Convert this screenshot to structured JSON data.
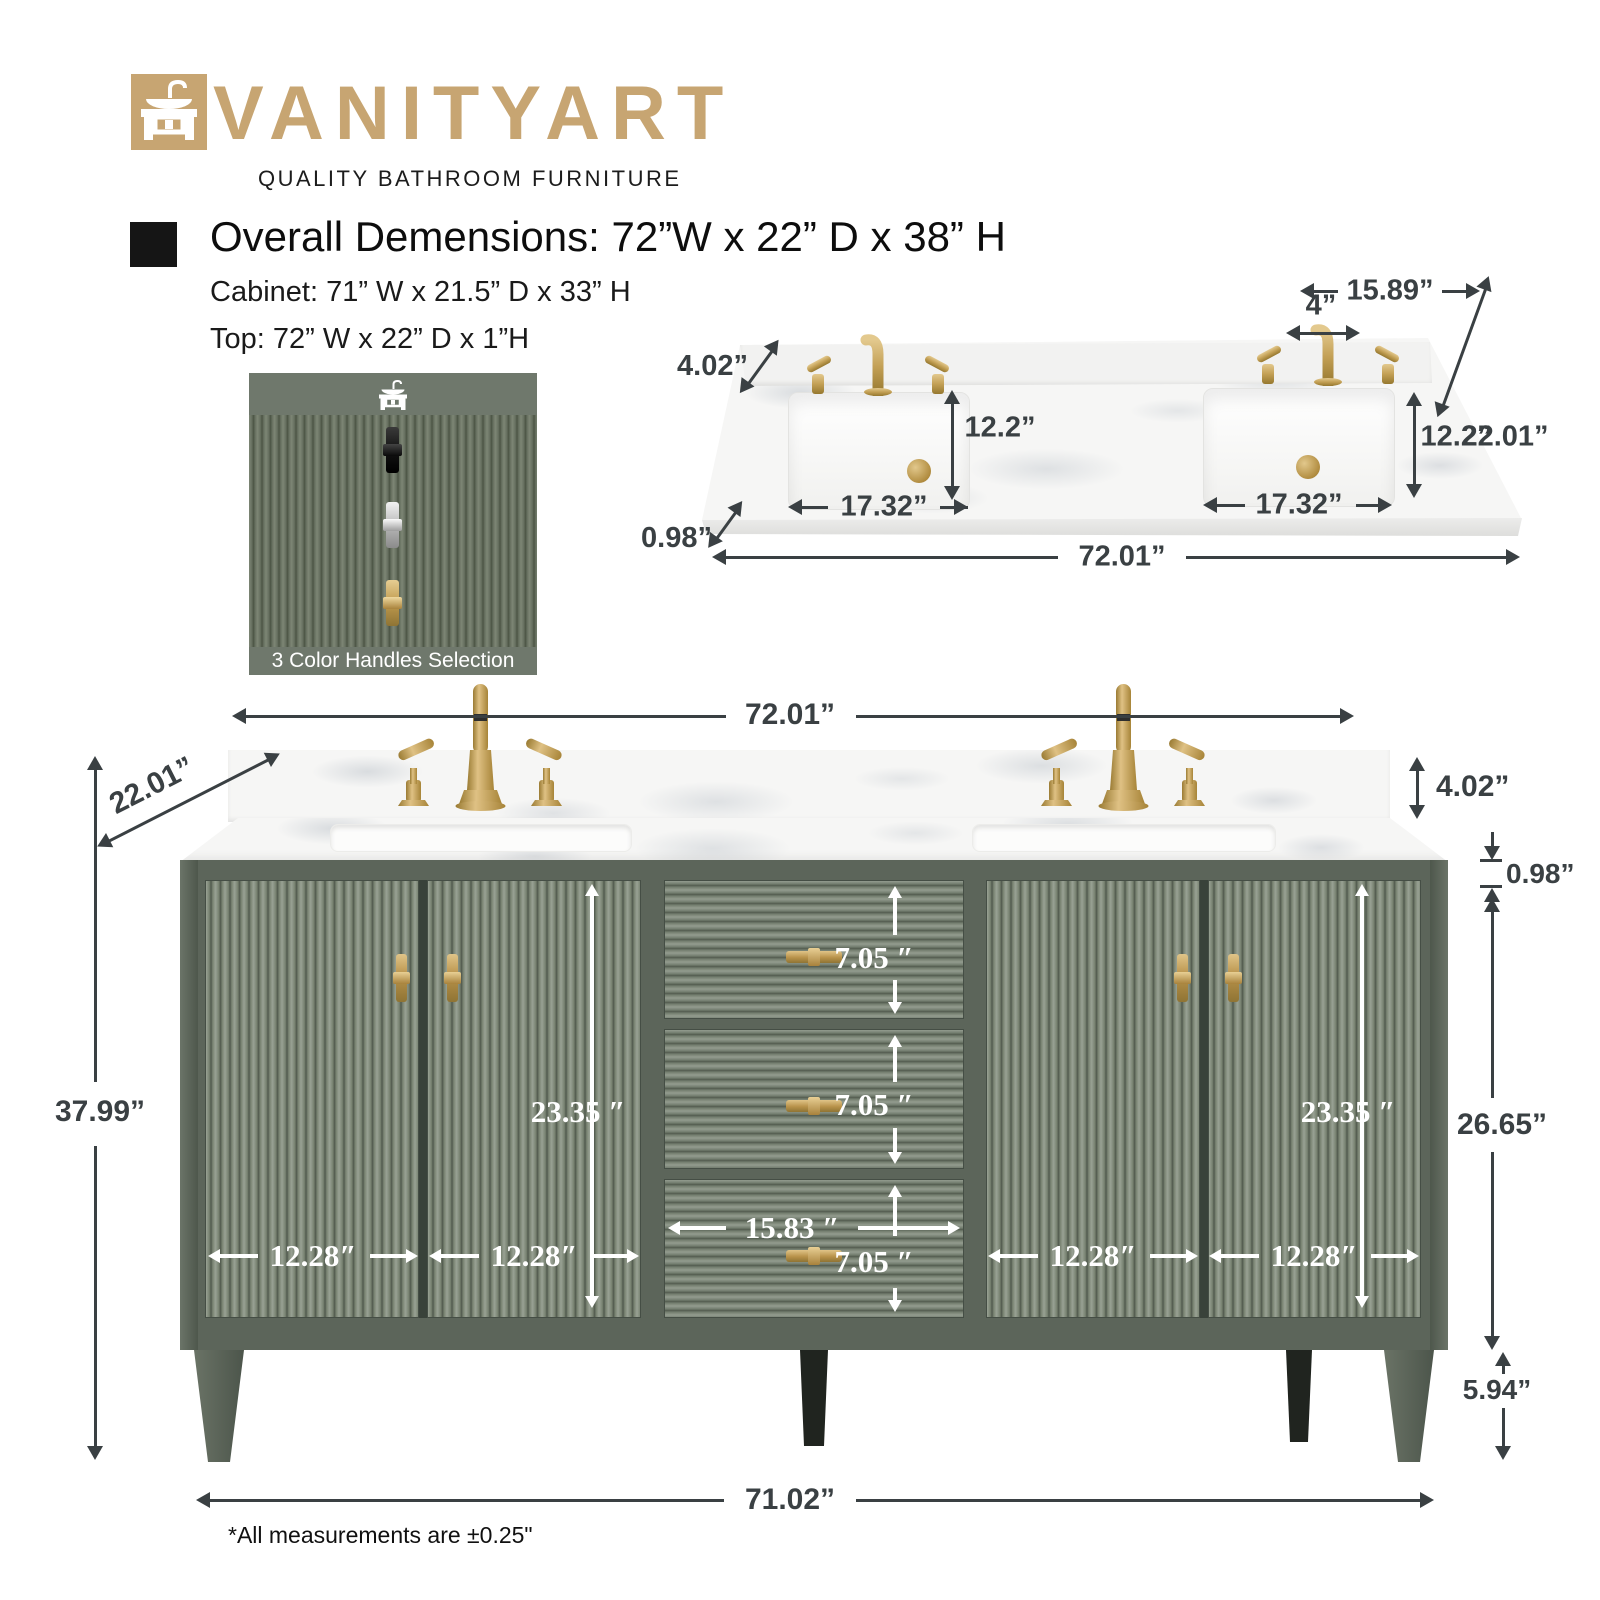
{
  "logo": {
    "brand": "VANITYART",
    "tagline": "QUALITY BATHROOM FURNITURE"
  },
  "header": {
    "title": "Overall Demensions: 72”W x 22” D x 38” H",
    "cabinet_line": "Cabinet: 71” W x 21.5” D x 33” H",
    "top_line": "Top: 72” W x 22” D x 1”H"
  },
  "handles_box": {
    "caption": "3 Color Handles Selection",
    "handle_options": [
      "black",
      "chrome",
      "gold"
    ]
  },
  "countertop": {
    "right_backsplash_width": "15.89”",
    "faucet_spacing": "4”",
    "backsplash_height": "4.02”",
    "sink_depth_left": "12.2”",
    "sink_depth_right": "12.2”",
    "depth": "22.01”",
    "sink_width_left": "17.32”",
    "sink_width_right": "17.32”",
    "thickness": "0.98”",
    "width": "72.01”"
  },
  "vanity": {
    "width": "72.01”",
    "depth": "22.01”",
    "backsplash_height": "4.02”",
    "top_thickness": "0.98”",
    "overall_height": "37.99”",
    "cabinet_height": "26.65”",
    "door_height_left": "23.35 ″",
    "door_height_right": "23.35 ″",
    "drawer_heights": [
      "7.05 ″",
      "7.05 ″",
      "7.05 ″"
    ],
    "drawer_width": "15.83 ″",
    "door_widths": [
      "12.28″",
      "12.28″",
      "12.28″",
      "12.28″"
    ],
    "leg_height": "5.94”",
    "base_width": "71.02”"
  },
  "footnote": "*All measurements are ±0.25\"",
  "colors": {
    "brand_gold": "#C7A572",
    "cabinet_green": "#5C655A",
    "hardware_gold": "#BF9A4E",
    "marble_white": "#F6F6F5",
    "dimension_dark": "#3A4043",
    "dimension_white": "#FFFFFF"
  }
}
